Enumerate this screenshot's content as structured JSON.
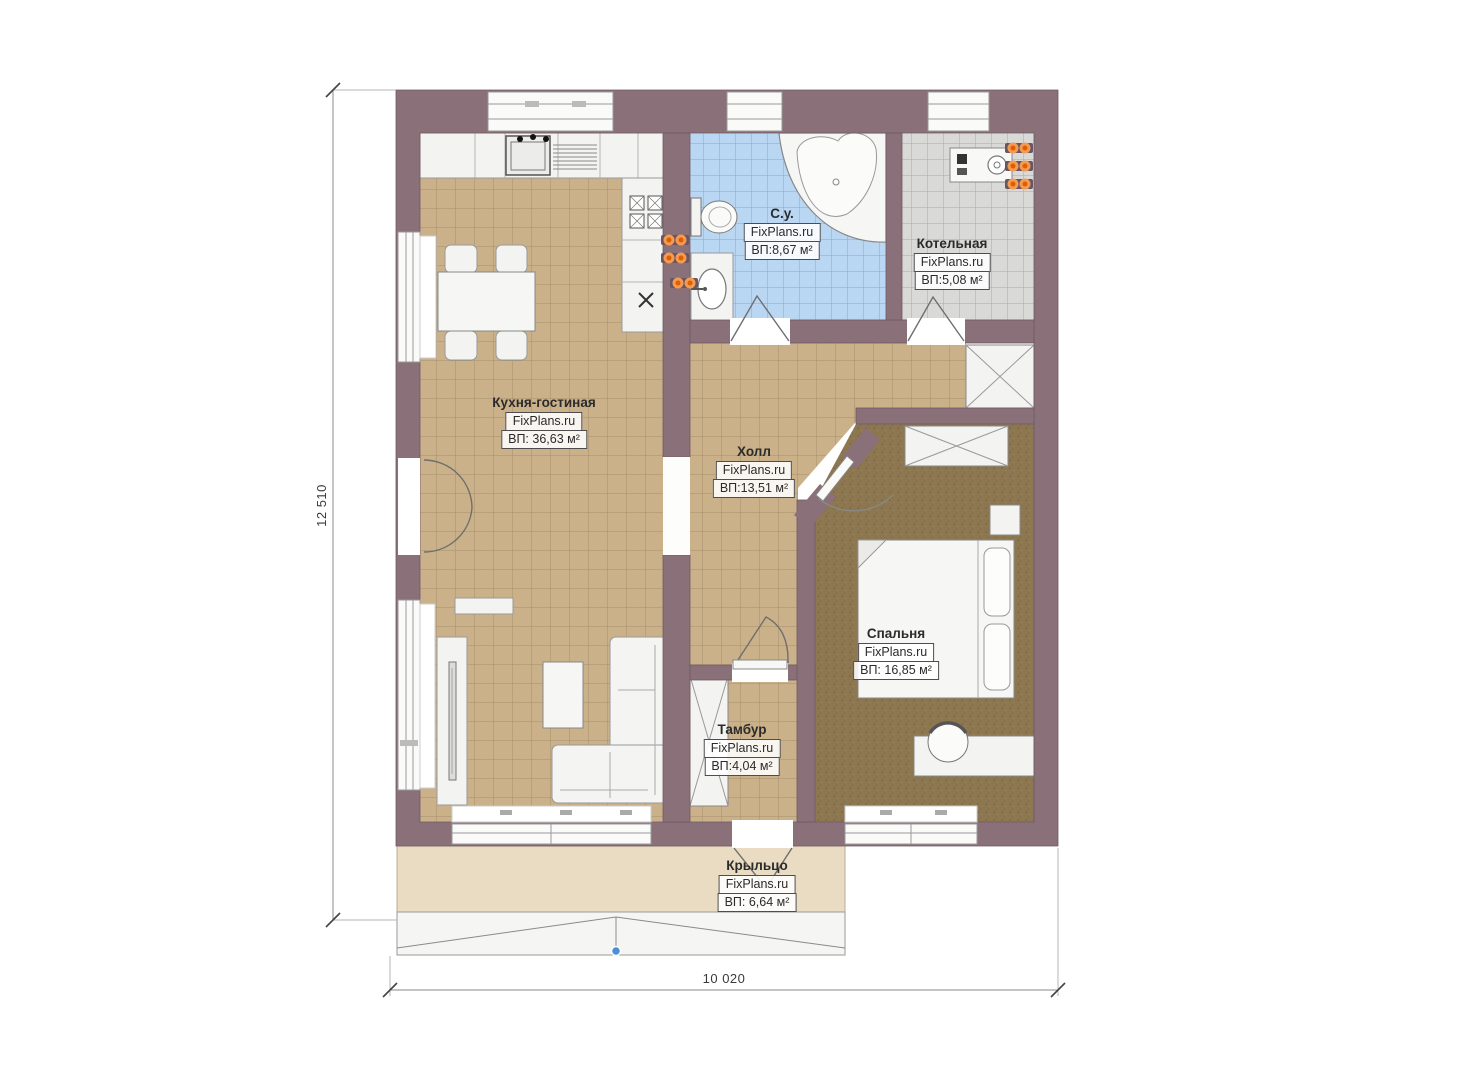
{
  "plan": {
    "site": "FixPlans.ru",
    "rooms": [
      {
        "id": "kitchen-living",
        "name": "Кухня-гостиная",
        "source": "FixPlans.ru",
        "area": "ВП: 36,63 м²"
      },
      {
        "id": "bathroom",
        "name": "С.у.",
        "source": "FixPlans.ru",
        "area": "ВП:8,67 м²"
      },
      {
        "id": "boiler",
        "name": "Котельная",
        "source": "FixPlans.ru",
        "area": "ВП:5,08 м²"
      },
      {
        "id": "hall",
        "name": "Холл",
        "source": "FixPlans.ru",
        "area": "ВП:13,51 м²"
      },
      {
        "id": "bedroom",
        "name": "Спальня",
        "source": "FixPlans.ru",
        "area": "ВП: 16,85 м²"
      },
      {
        "id": "tambour",
        "name": "Тамбур",
        "source": "FixPlans.ru",
        "area": "ВП:4,04 м²"
      },
      {
        "id": "porch",
        "name": "Крыльцо",
        "source": "FixPlans.ru",
        "area": "ВП: 6,64 м²"
      }
    ],
    "dimensions": {
      "width_label": "10 020",
      "height_label": "12 510"
    },
    "colors": {
      "wall": "#897079",
      "tile_tan": "#cbb189",
      "tile_blue": "#b9d6f2",
      "tile_gray": "#d9d9d8",
      "bedroom_floor": "#8c7750",
      "porch": "#e9dcc3",
      "radiator_orange": "#e87a1f",
      "marker_blue": "#4a90d9"
    }
  }
}
